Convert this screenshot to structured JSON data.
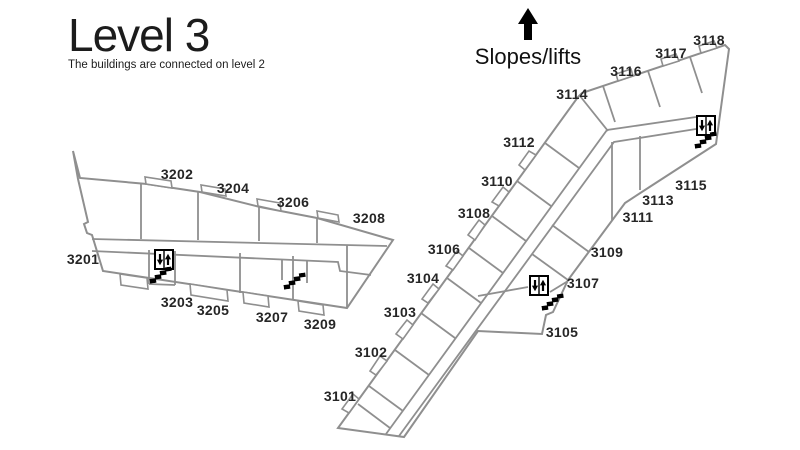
{
  "title": {
    "text": "Level 3",
    "subtitle": "The buildings are connected on level 2"
  },
  "legend": {
    "label": "Slopes/lifts"
  },
  "colors": {
    "background": "#ffffff",
    "wall": "#8f8f8f",
    "text": "#231f20",
    "icon": "#000000"
  },
  "west_building": {
    "rooms": [
      {
        "id": "3201",
        "x": 83,
        "y": 259
      },
      {
        "id": "3202",
        "x": 177,
        "y": 174
      },
      {
        "id": "3203",
        "x": 177,
        "y": 302
      },
      {
        "id": "3204",
        "x": 233,
        "y": 188
      },
      {
        "id": "3205",
        "x": 213,
        "y": 310
      },
      {
        "id": "3206",
        "x": 293,
        "y": 202
      },
      {
        "id": "3207",
        "x": 272,
        "y": 317
      },
      {
        "id": "3208",
        "x": 369,
        "y": 218
      },
      {
        "id": "3209",
        "x": 320,
        "y": 324
      }
    ]
  },
  "east_building": {
    "rooms": [
      {
        "id": "3101",
        "x": 340,
        "y": 396
      },
      {
        "id": "3102",
        "x": 371,
        "y": 352
      },
      {
        "id": "3103",
        "x": 400,
        "y": 312
      },
      {
        "id": "3104",
        "x": 423,
        "y": 278
      },
      {
        "id": "3105",
        "x": 562,
        "y": 332
      },
      {
        "id": "3106",
        "x": 444,
        "y": 249
      },
      {
        "id": "3107",
        "x": 583,
        "y": 283
      },
      {
        "id": "3108",
        "x": 474,
        "y": 213
      },
      {
        "id": "3109",
        "x": 607,
        "y": 252
      },
      {
        "id": "3110",
        "x": 497,
        "y": 181
      },
      {
        "id": "3111",
        "x": 638,
        "y": 217
      },
      {
        "id": "3112",
        "x": 519,
        "y": 142
      },
      {
        "id": "3113",
        "x": 658,
        "y": 200
      },
      {
        "id": "3114",
        "x": 572,
        "y": 94
      },
      {
        "id": "3115",
        "x": 691,
        "y": 185
      },
      {
        "id": "3116",
        "x": 626,
        "y": 71
      },
      {
        "id": "3117",
        "x": 671,
        "y": 53
      },
      {
        "id": "3118",
        "x": 709,
        "y": 40
      }
    ]
  },
  "icons": {
    "elevators": [
      {
        "x": 154,
        "y": 249
      },
      {
        "x": 529,
        "y": 275
      },
      {
        "x": 696,
        "y": 115
      }
    ],
    "stairs": [
      {
        "x": 149,
        "y": 268
      },
      {
        "x": 283,
        "y": 274
      },
      {
        "x": 541,
        "y": 295
      },
      {
        "x": 694,
        "y": 133
      }
    ]
  }
}
